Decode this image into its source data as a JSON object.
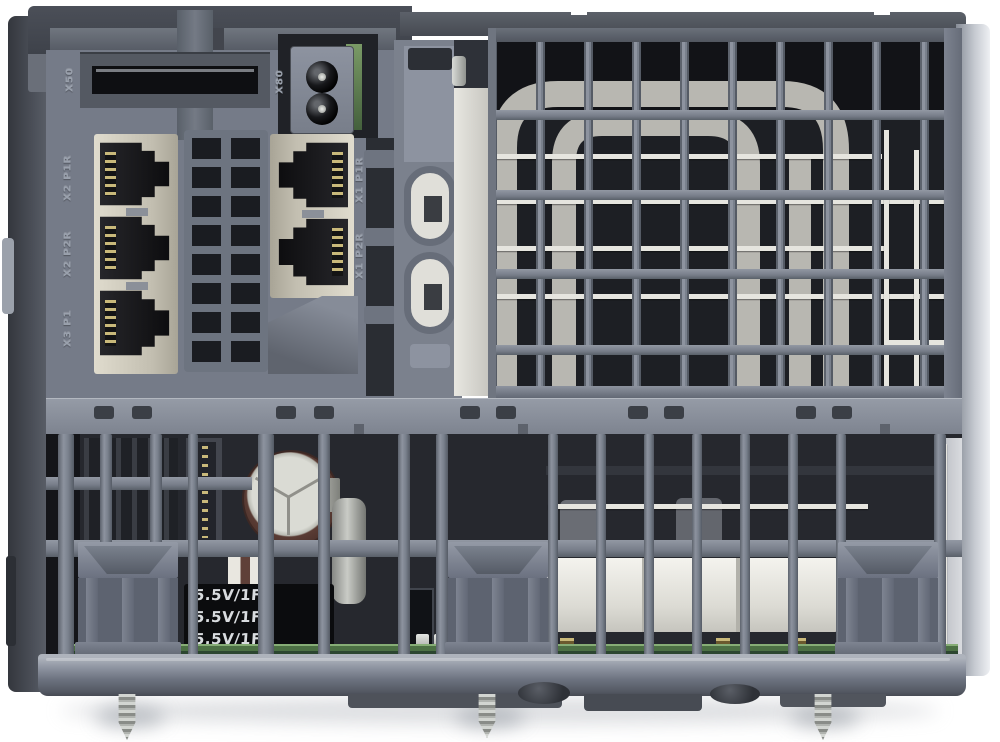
{
  "labels": {
    "memory_card_slot": "X50",
    "power_connector": "X80",
    "port_x2_p1r": "X2 P1R",
    "port_x2_p2r": "X2 P2R",
    "port_x3_p1": "X3 P1",
    "port_x1_p1r": "X1 P1R",
    "port_x1_p2r": "X1 P2R"
  },
  "supercap": {
    "lines": [
      "5.5V/1F",
      "5.5V/1F",
      "5.5V/1F"
    ]
  },
  "colors": {
    "body": "#7d8390",
    "body_dark": "#43464d",
    "panel": "#757b88",
    "opening": "#1b1d22",
    "cable": "#b8b7b1",
    "rod": "#e6e5df",
    "shield": "#d6d2c4",
    "gold": "#c9b97a",
    "pcb": "#4c7044",
    "cap_sleeve": "#523630",
    "cap_top": "#d6d6d0",
    "white_bar": "#edece6",
    "label_emboss": "#9aa1ad",
    "supercap_text": "#d9dcdf",
    "screw_light": "#c9ccc8",
    "screw_dark": "#8e918d"
  }
}
